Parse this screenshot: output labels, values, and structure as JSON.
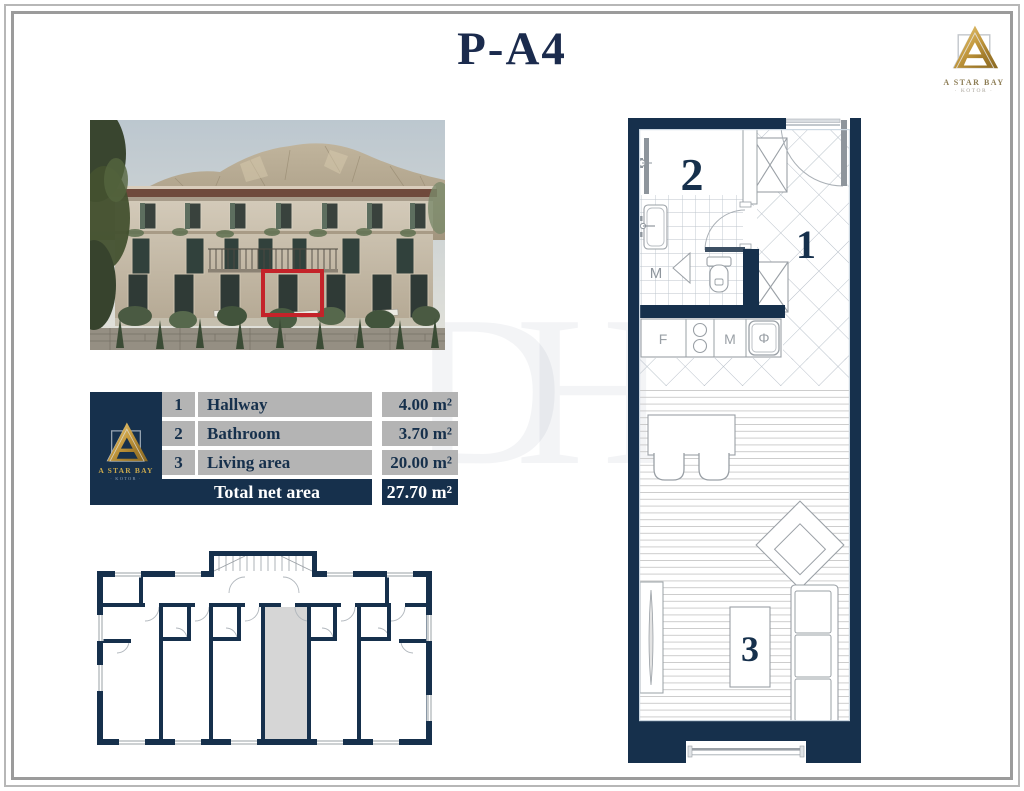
{
  "title": "P-A4",
  "brand": {
    "name": "A STAR BAY",
    "city": "KOTOR",
    "city_decorated": "· KOTOR ·"
  },
  "watermark": "DH",
  "area_table": {
    "rows": [
      {
        "num": "1",
        "label": "Hallway",
        "value": "4.00 m²"
      },
      {
        "num": "2",
        "label": "Bathroom",
        "value": "3.70 m²"
      },
      {
        "num": "3",
        "label": "Living area",
        "value": "20.00 m²"
      }
    ],
    "total": {
      "label": "Total net area",
      "value": "27.70 m²"
    }
  },
  "floor_plan": {
    "labels": {
      "hallway": "1",
      "bathroom": "2",
      "living_area": "3"
    },
    "symbols": {
      "bath_washer": "M",
      "fridge": "F",
      "kitchen_washer": "M",
      "sink": "Φ"
    }
  },
  "colors": {
    "navy": "#16304c",
    "gold": "#c2993e",
    "table_gray": "#b4b4b4",
    "highlight_red": "#c4232a",
    "unit_highlight_gray": "#d6d6d6"
  }
}
